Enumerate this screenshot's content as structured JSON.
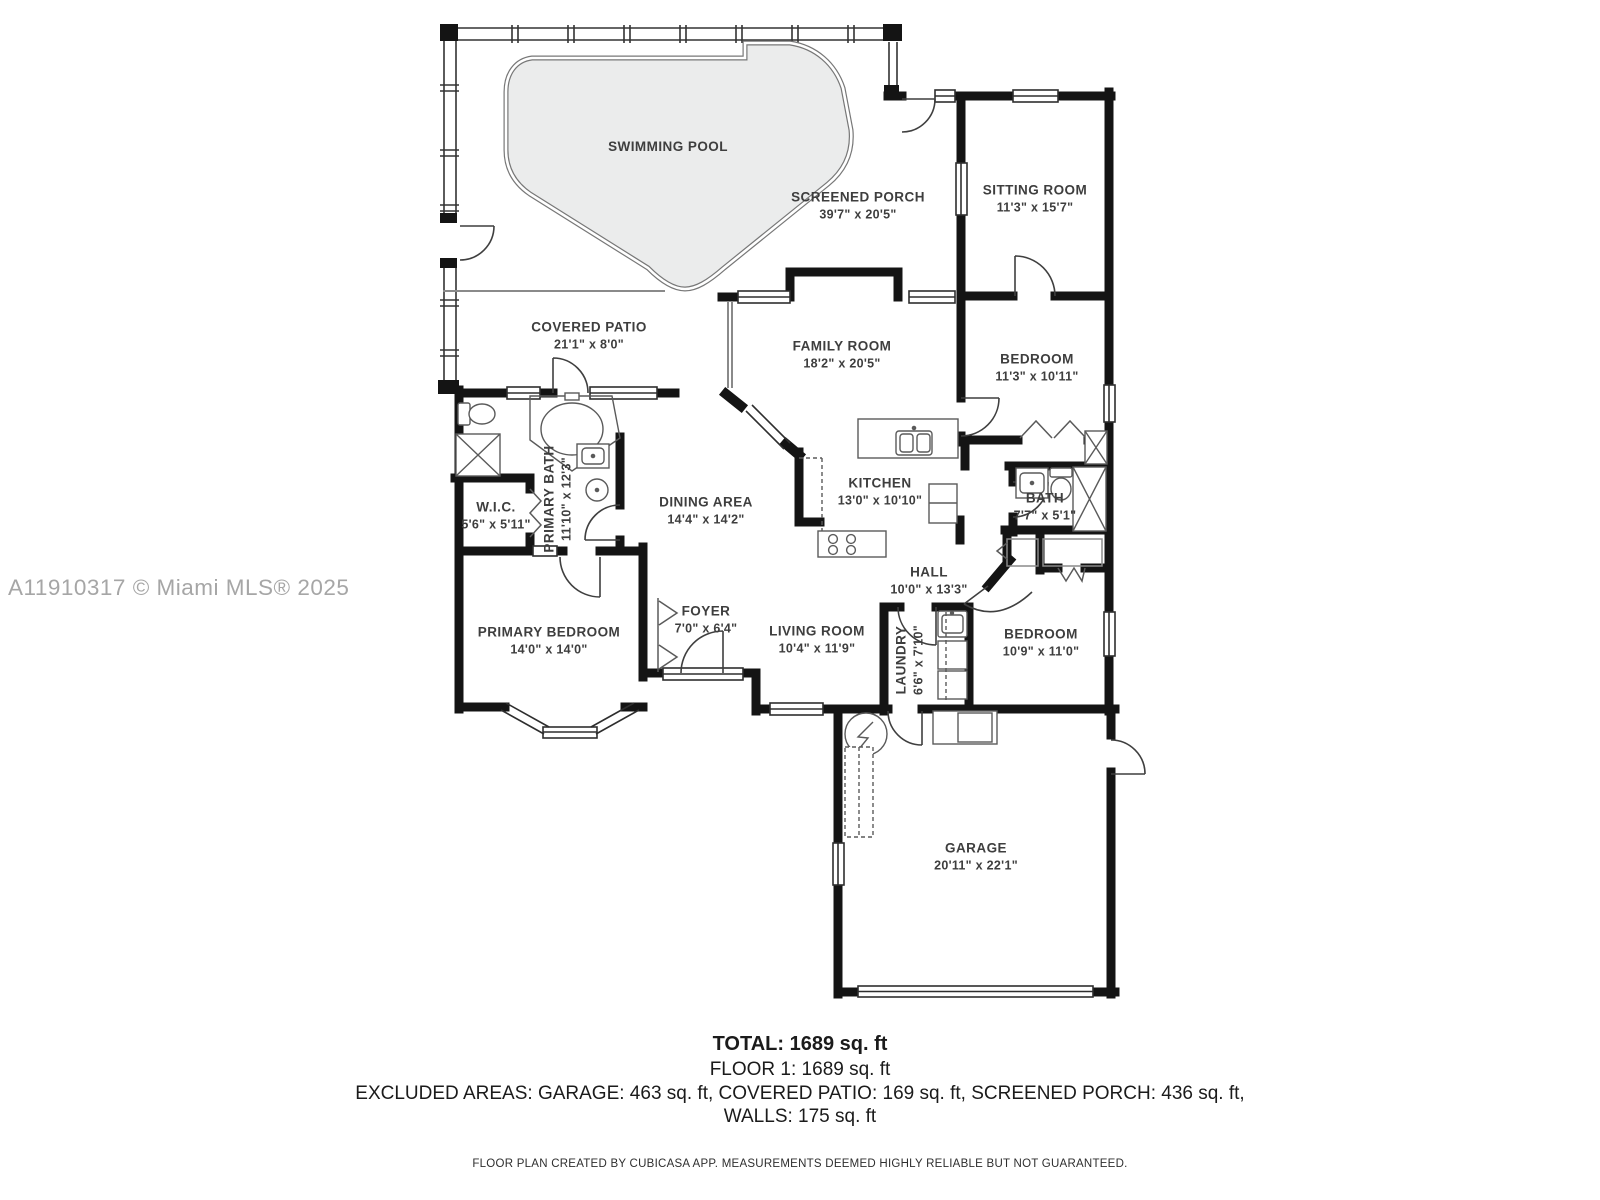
{
  "watermark": "A11910317 © Miami MLS® 2025",
  "rooms": {
    "swimming_pool": {
      "name": "SWIMMING POOL",
      "dims": ""
    },
    "screened_porch": {
      "name": "SCREENED PORCH",
      "dims": "39'7\" x 20'5\""
    },
    "sitting_room": {
      "name": "SITTING ROOM",
      "dims": "11'3\" x 15'7\""
    },
    "covered_patio": {
      "name": "COVERED PATIO",
      "dims": "21'1\" x 8'0\""
    },
    "family_room": {
      "name": "FAMILY ROOM",
      "dims": "18'2\" x 20'5\""
    },
    "bedroom_top": {
      "name": "BEDROOM",
      "dims": "11'3\" x 10'11\""
    },
    "primary_bath": {
      "name": "PRIMARY BATH",
      "dims": "11'10\" x 12'3\""
    },
    "wic": {
      "name": "W.I.C.",
      "dims": "5'6\" x 5'11\""
    },
    "dining_area": {
      "name": "DINING AREA",
      "dims": "14'4\" x 14'2\""
    },
    "kitchen": {
      "name": "KITCHEN",
      "dims": "13'0\" x 10'10\""
    },
    "bath": {
      "name": "BATH",
      "dims": "7'7\" x 5'1\""
    },
    "hall": {
      "name": "HALL",
      "dims": "10'0\" x 13'3\""
    },
    "primary_bedroom": {
      "name": "PRIMARY BEDROOM",
      "dims": "14'0\" x 14'0\""
    },
    "foyer": {
      "name": "FOYER",
      "dims": "7'0\" x 6'4\""
    },
    "living_room": {
      "name": "LIVING ROOM",
      "dims": "10'4\" x 11'9\""
    },
    "laundry": {
      "name": "LAUNDRY",
      "dims": "6'6\" x 7'10\""
    },
    "bedroom_bottom": {
      "name": "BEDROOM",
      "dims": "10'9\" x 11'0\""
    },
    "garage": {
      "name": "GARAGE",
      "dims": "20'11\" x 22'1\""
    }
  },
  "summary": {
    "total": "TOTAL: 1689 sq. ft",
    "floor": "FLOOR 1: 1689 sq. ft",
    "excluded": "EXCLUDED AREAS: GARAGE: 463 sq. ft, COVERED PATIO: 169 sq. ft, SCREENED PORCH: 436 sq. ft,",
    "walls": "WALLS: 175 sq. ft",
    "disclaimer": "FLOOR PLAN CREATED BY CUBICASA APP. MEASUREMENTS DEEMED HIGHLY RELIABLE BUT NOT GUARANTEED."
  },
  "colors": {
    "wall": "#141414",
    "pool_fill": "#ebecec",
    "pool_edge": "#777777",
    "label": "#3e3e3e",
    "watermark": "#a6a6a6"
  }
}
